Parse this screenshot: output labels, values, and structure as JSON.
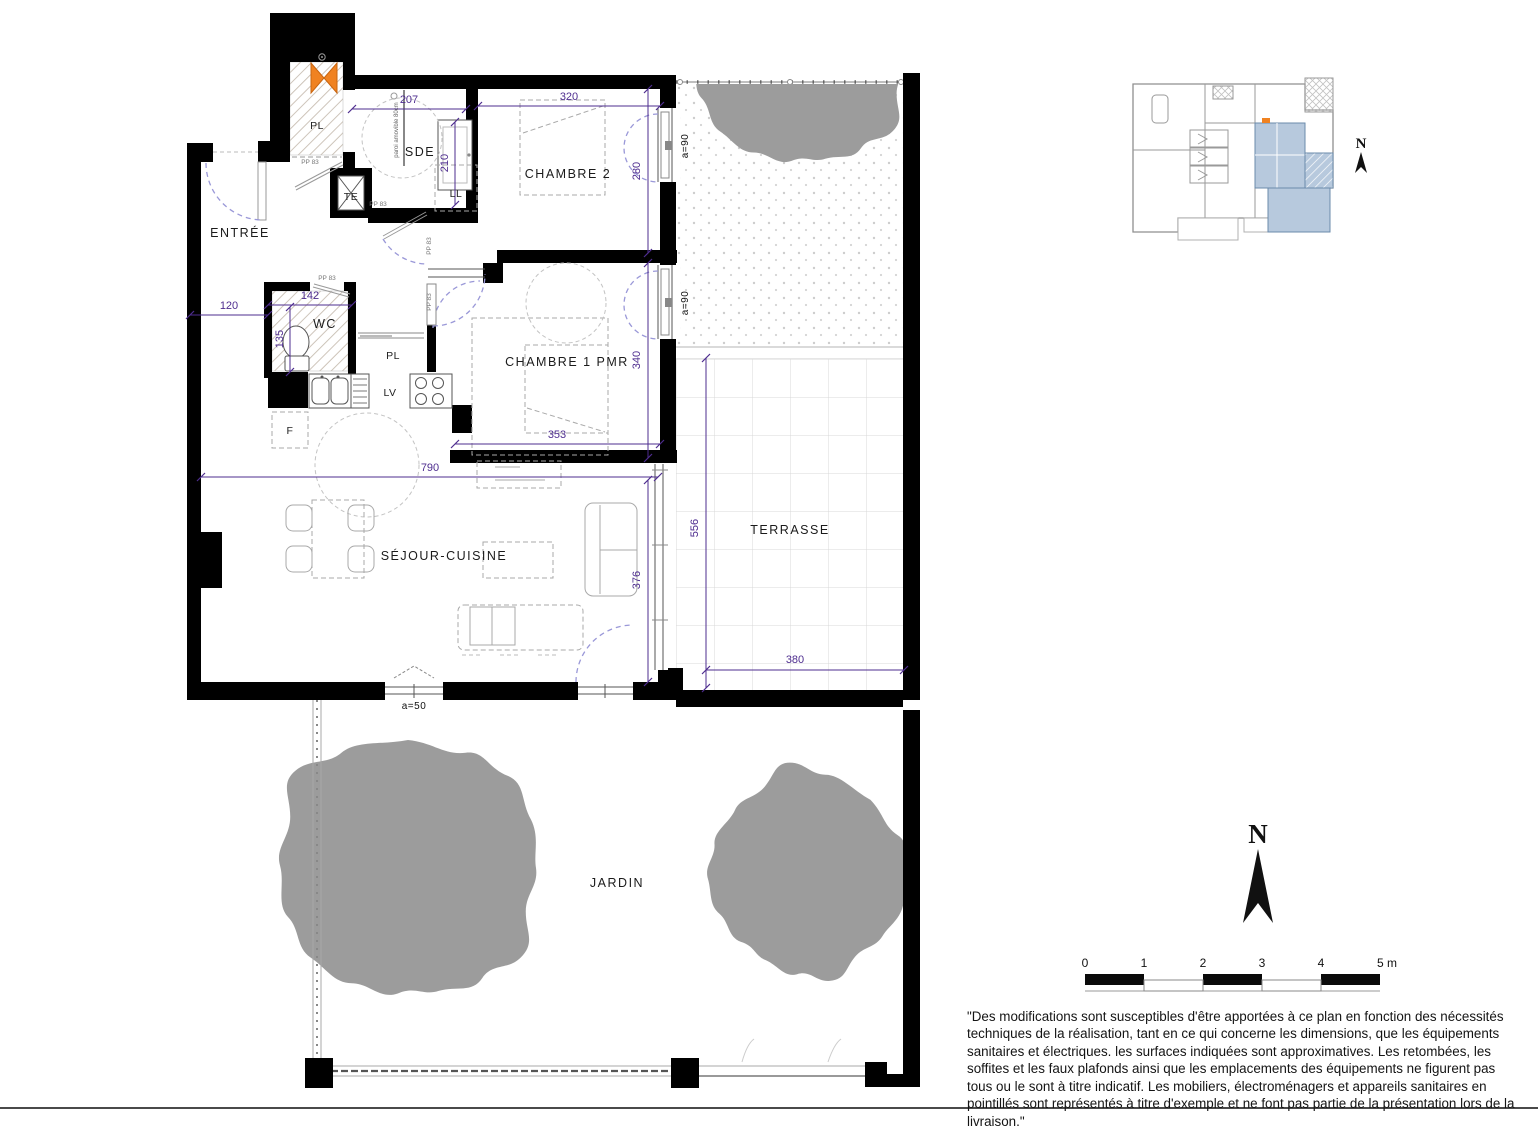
{
  "rooms": {
    "entree": "ENTRÉE",
    "sde": "SDE",
    "chambre2": "CHAMBRE 2",
    "chambre1": "CHAMBRE 1 PMR",
    "wc": "WC",
    "sejour": "SÉJOUR-CUISINE",
    "terrasse": "TERRASSE",
    "jardin": "JARDIN"
  },
  "fixtures": {
    "pl": "PL",
    "te": "TE",
    "ll": "LL",
    "lv": "LV",
    "f": "F",
    "paroi": "paroi amovible 80cm"
  },
  "doors": {
    "pp83": "PP 83"
  },
  "windows": {
    "a90": "a=90",
    "a50": "a=50"
  },
  "dims": {
    "d207": "207",
    "d320": "320",
    "d280": "280",
    "d210": "210",
    "d340": "340",
    "d353": "353",
    "d790": "790",
    "d376": "376",
    "d120": "120",
    "d142": "142",
    "d135": "135",
    "d556": "556",
    "d380": "380"
  },
  "compass": {
    "north": "N"
  },
  "scalebar": {
    "t0": "0",
    "t1": "1",
    "t2": "2",
    "t3": "3",
    "t4": "4",
    "t5": "5 m"
  },
  "disclaimer": "\"Des modifications sont susceptibles d'être apportées à ce plan en fonction des nécessités techniques de la réalisation, tant en ce qui concerne les dimensions, que les équipements sanitaires et électriques. les surfaces indiquées sont approximatives. Les retombées, les soffites et les faux plafonds ainsi que les emplacements des équipements ne figurent pas tous ou le sont à titre indicatif. Les mobiliers, électroménagers et appareils sanitaires en pointillés sont représentés à titre d'exemple et ne font pas partie de la présentation lors de la livraison.\"",
  "colors": {
    "wall": "#000000",
    "dimension": "#4e2d8f",
    "door_arc": "#9a98d8",
    "tree": "#9c9c9c",
    "keyplan_highlight": "#b7c9dd",
    "accent_orange": "#f08221"
  }
}
